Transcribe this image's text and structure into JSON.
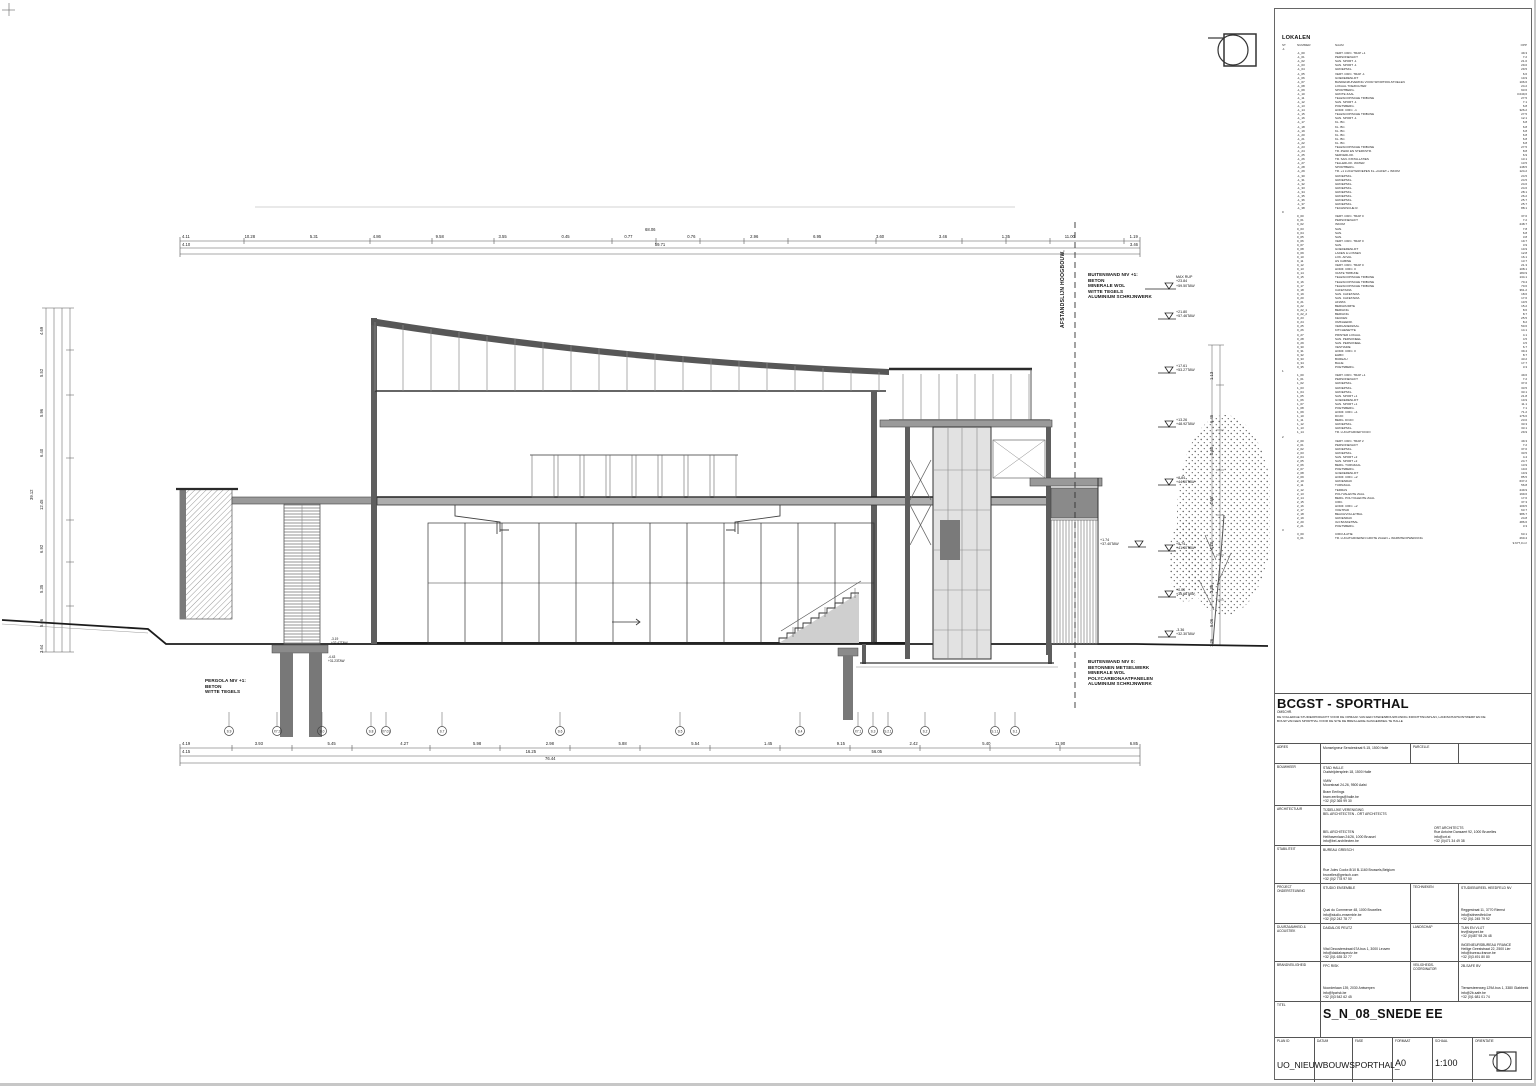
{
  "sheet": {
    "annotations": {
      "buitenwand1": "BUITENWAND NIV +1:\nBETON\nMINERALE WOL\nWITTE TEGELS\nALUMINIUM SCHRIJNWERK",
      "buitenwand0": "BUITENWAND NIV 0:\nBETONNEN METSELWERK\nMINERALE WOL\nPOLYCARBONAATPANELEN\nALUMINIUM SCHRIJNWERK",
      "pergola": "PERGOLA NIV +1:\nBETON\nWITTE TEGELS",
      "afstandslijn": "AFSTANDSLIJN HOOGBOUW,"
    },
    "levels": [
      {
        "top": "MAX RUP",
        "a": "+23.84",
        "b": "+59.50TAW"
      },
      {
        "top": "",
        "a": "+21.80",
        "b": "+57.46TAW"
      },
      {
        "top": "",
        "a": "+17.61",
        "b": "+53.27TAW"
      },
      {
        "top": "",
        "a": "+13.26",
        "b": "+48.92TAW"
      },
      {
        "top": "",
        "a": "+8.84",
        "b": "+44.50TAW"
      },
      {
        "top": "",
        "a": "+5.74",
        "b": "+41.40TAW"
      },
      {
        "top": "",
        "a": "+0.00",
        "b": "+35.66TAW"
      },
      {
        "top": "",
        "a": "-3.36",
        "b": "+32.30TAW"
      }
    ],
    "marks": {
      "mid": "+1.74\n+37.40TAW",
      "foot1": "-3.19\n+32.47TAW",
      "foot2": "-4.43\n+31.23TAW"
    },
    "dims": {
      "top_total": "68.06",
      "top1": [
        "4.11",
        "10.28",
        "5.31",
        "4.86",
        "9.58",
        "3.55",
        "0.45",
        "0.77",
        "0.76",
        "2.96",
        "6.95",
        "3.60",
        "3.46",
        "1.35",
        "11.00",
        "1.19"
      ],
      "top2": [
        "4.10",
        "59.71",
        "3.46"
      ],
      "bot1": [
        "4.19",
        "3.93",
        "5.45",
        "4.27",
        "5.98",
        "2.98",
        "5.88",
        "5.54",
        "1.45",
        "9.15",
        "2.42",
        "5.40",
        "11.90",
        "6.85"
      ],
      "bot2": [
        "4.15",
        "16.25",
        "56.05"
      ],
      "bot_total": "76.44",
      "left": [
        "4.69",
        "5.52",
        "5.96",
        "6.40",
        "12.45",
        "6.92",
        "5.35",
        "5.06",
        "3.64"
      ],
      "left_total": "39.12",
      "right": [
        "1.13",
        "6.45",
        "0.60",
        "4.65",
        "4.10",
        "3.35",
        "5.06",
        "1.26"
      ]
    },
    "grid": {
      "bubbles": [
        "S.9",
        "X7.2",
        "S.0",
        "S.8",
        "X7.01",
        "S.7",
        "S.6",
        "S.5",
        "S.4",
        "X7.1",
        "S.3",
        "S.2.1",
        "S.2",
        "S.1.1",
        "S.1"
      ]
    }
  },
  "lokalen": {
    "title": "LOKALEN",
    "headers": {
      "st": "ST",
      "nr": "NUMMER",
      "naam": "NAAM",
      "opp": "OPP"
    },
    "rows": [
      {
        "st": "-1",
        "nr": "",
        "naam": "",
        "opp": ""
      },
      {
        "st": "",
        "nr": "-1_00",
        "naam": "VERT. CIRC. TRAP +1",
        "opp": "49.3"
      },
      {
        "st": "",
        "nr": "-1_01",
        "naam": "PERSONENLIFT",
        "opp": "7.2"
      },
      {
        "st": "",
        "nr": "-1_02",
        "naam": "SAN. SPORT -1",
        "opp": "21.0"
      },
      {
        "st": "",
        "nr": "-1_03",
        "naam": "SAN. SPORT -1",
        "opp": "29.0"
      },
      {
        "st": "",
        "nr": "-1_04",
        "naam": "GROEPSKL.",
        "opp": "29.5"
      },
      {
        "st": "",
        "nr": "-1_05",
        "naam": "VERT. CIRC. TRAP -1",
        "opp": "6.6"
      },
      {
        "st": "",
        "nr": "-1_06",
        "naam": "GOEDERENLIFT",
        "opp": "10.9"
      },
      {
        "st": "",
        "nr": "-1_07",
        "naam": "BANDENZUIVERING VOOR SPORTROLSTOELEN",
        "opp": "106.6"
      },
      {
        "st": "",
        "nr": "-1_08",
        "naam": "LOKAAL TOEZICHTER",
        "opp": "24.2"
      },
      {
        "st": "",
        "nr": "-1_09",
        "naam": "SPORTBERG.",
        "opp": "93.6"
      },
      {
        "st": "",
        "nr": "-1_10",
        "naam": "GROTE ZAAL",
        "opp": "3.049,6"
      },
      {
        "st": "",
        "nr": "-1_11",
        "naam": "TELESCOPISCHE TRIBUNE",
        "opp": "27.5"
      },
      {
        "st": "",
        "nr": "-1_12",
        "naam": "SAN. SPORT -1",
        "opp": "7.1"
      },
      {
        "st": "",
        "nr": "-1_13",
        "naam": "POETSBERG.",
        "opp": "6.8"
      },
      {
        "st": "",
        "nr": "-1_14",
        "naam": "HORZ. CIRC. -1",
        "opp": "326.2"
      },
      {
        "st": "",
        "nr": "-1_15",
        "naam": "TELESCOPISCHE TRIBUNE",
        "opp": "27.5"
      },
      {
        "st": "",
        "nr": "-1_16",
        "naam": "SAN. SPORT -1",
        "opp": "12.1"
      },
      {
        "st": "",
        "nr": "-1_17",
        "naam": "KL. BC.",
        "opp": "6.8"
      },
      {
        "st": "",
        "nr": "-1_18",
        "naam": "KL. BC.",
        "opp": "6.8"
      },
      {
        "st": "",
        "nr": "-1_19",
        "naam": "KL. BC.",
        "opp": "6.8"
      },
      {
        "st": "",
        "nr": "-1_20",
        "naam": "KL. BC.",
        "opp": "6.8"
      },
      {
        "st": "",
        "nr": "-1_21",
        "naam": "KL. BC.",
        "opp": "6.8"
      },
      {
        "st": "",
        "nr": "-1_22",
        "naam": "KL. BC.",
        "opp": "6.8"
      },
      {
        "st": "",
        "nr": "-1_23",
        "naam": "TELESCOPISCHE TRIBUNE",
        "opp": "27.5"
      },
      {
        "st": "",
        "nr": "-1_24",
        "naam": "TR. ZWAK EN STERKSTR.",
        "opp": "8.8"
      },
      {
        "st": "",
        "nr": "-1_25",
        "naam": "SERVERLOK.",
        "opp": "6.9"
      },
      {
        "st": "",
        "nr": "-1_26",
        "naam": "TR. SAN. INSTALLATIES",
        "opp": "13.1"
      },
      {
        "st": "",
        "nr": "-1_27",
        "naam": "TELLERLOK. WATER",
        "opp": "13.5"
      },
      {
        "st": "",
        "nr": "-1_28",
        "naam": "SPORTBERG.",
        "opp": "148.5"
      },
      {
        "st": "",
        "nr": "-1_29",
        "naam": "TR. +1 LUCHTGROEPEN KL.+CAFET.+ INKOM",
        "opp": "124.2"
      },
      {
        "st": "",
        "nr": "-1_30",
        "naam": "GROEPSKL.",
        "opp": "24.5"
      },
      {
        "st": "",
        "nr": "-1_31",
        "naam": "GROEPSKL.",
        "opp": "24.5"
      },
      {
        "st": "",
        "nr": "-1_32",
        "naam": "GROEPSKL.",
        "opp": "24.6"
      },
      {
        "st": "",
        "nr": "-1_33",
        "naam": "GROEPSKL.",
        "opp": "24.6"
      },
      {
        "st": "",
        "nr": "-1_34",
        "naam": "GROEPSKL.",
        "opp": "28.1"
      },
      {
        "st": "",
        "nr": "-1_35",
        "naam": "GROEPSKL.",
        "opp": "26.2"
      },
      {
        "st": "",
        "nr": "-1_36",
        "naam": "GROEPSKL.",
        "opp": "25.7"
      },
      {
        "st": "",
        "nr": "-1_37",
        "naam": "GROEPSKL.",
        "opp": "25.7"
      },
      {
        "st": "",
        "nr": "-1_38",
        "naam": "TECHNISCHE R.",
        "opp": "88.1"
      },
      {
        "st": "0",
        "nr": "",
        "naam": "",
        "opp": ""
      },
      {
        "st": "",
        "nr": "0_00",
        "naam": "VERT. CIRC. TRAP 0",
        "opp": "37.0"
      },
      {
        "st": "",
        "nr": "0_01",
        "naam": "PERSONENLIFT",
        "opp": "7.2"
      },
      {
        "st": "",
        "nr": "0_02",
        "naam": "INKOM",
        "opp": "248.7"
      },
      {
        "st": "",
        "nr": "0_03",
        "naam": "SAN.",
        "opp": "7.8"
      },
      {
        "st": "",
        "nr": "0_04",
        "naam": "SAN.",
        "opp": "6.8"
      },
      {
        "st": "",
        "nr": "0_05",
        "naam": "SAN.",
        "opp": "3.8"
      },
      {
        "st": "",
        "nr": "0_06",
        "naam": "VERT. CIRC. TRAP 0",
        "opp": "19.7"
      },
      {
        "st": "",
        "nr": "0_07",
        "naam": "SAN.",
        "opp": "3.9"
      },
      {
        "st": "",
        "nr": "0_08",
        "naam": "GOEDERENLIFT",
        "opp": "10.9"
      },
      {
        "st": "",
        "nr": "0_09",
        "naam": "LADEN & LOSSEN",
        "opp": "12.8"
      },
      {
        "st": "",
        "nr": "0_10",
        "naam": "LOK. AFVAL",
        "opp": "16.1"
      },
      {
        "st": "",
        "nr": "0_11",
        "naam": "HS CABINE",
        "opp": "13.7"
      },
      {
        "st": "",
        "nr": "0_12",
        "naam": "VERT. CIRC. TRAP 0",
        "opp": "21.3"
      },
      {
        "st": "",
        "nr": "0_13",
        "naam": "HORZ. CIRC. 0",
        "opp": "108.1"
      },
      {
        "st": "",
        "nr": "0_14",
        "naam": "VASTE TRIBUNE",
        "opp": "183.9"
      },
      {
        "st": "",
        "nr": "0_15",
        "naam": "TELESCOPISCHE TRIBUNE",
        "opp": "134.1"
      },
      {
        "st": "",
        "nr": "0_16",
        "naam": "TELESCOPISCHE TRIBUNE",
        "opp": "70.4"
      },
      {
        "st": "",
        "nr": "0_17",
        "naam": "TELESCOPISCHE TRIBUNE",
        "opp": "70.6"
      },
      {
        "st": "",
        "nr": "0_18",
        "naam": "CAFETARIA",
        "opp": "361.2"
      },
      {
        "st": "",
        "nr": "0_19",
        "naam": "SAN. CAFETARIA",
        "opp": "18.6"
      },
      {
        "st": "",
        "nr": "0_20",
        "naam": "SAN. CAFETARIA",
        "opp": "17.6"
      },
      {
        "st": "",
        "nr": "0_21",
        "naam": "AFWAS",
        "opp": "10.5"
      },
      {
        "st": "",
        "nr": "0_22",
        "naam": "BERGRUIMTE",
        "opp": "15.2"
      },
      {
        "st": "",
        "nr": "0_22_1",
        "naam": "BERGING",
        "opp": "8.6"
      },
      {
        "st": "",
        "nr": "0_22_2",
        "naam": "BERGING",
        "opp": "8.7"
      },
      {
        "st": "",
        "nr": "0_23",
        "naam": "KEUKEN",
        "opp": "25.5"
      },
      {
        "st": "",
        "nr": "0_24",
        "naam": "OMKLEEDR.",
        "opp": "8.2"
      },
      {
        "st": "",
        "nr": "0_25",
        "naam": "VERGADERZAAL",
        "opp": "50.6"
      },
      {
        "st": "",
        "nr": "0_26",
        "naam": "KITCHENETTE",
        "opp": "14.1"
      },
      {
        "st": "",
        "nr": "0_27",
        "naam": "PRINTER LOKAAL",
        "opp": "4.1"
      },
      {
        "st": "",
        "nr": "0_28",
        "naam": "SAN. PERSONEEL",
        "opp": "4.5"
      },
      {
        "st": "",
        "nr": "0_29",
        "naam": "SAN. PERSONEEL",
        "opp": "4.5"
      },
      {
        "st": "",
        "nr": "0_30",
        "naam": "VESTIAIRE",
        "opp": "6.7"
      },
      {
        "st": "",
        "nr": "0_31",
        "naam": "HORZ. CIRC. 0",
        "opp": "39.4"
      },
      {
        "st": "",
        "nr": "0_32",
        "naam": "EHBO",
        "opp": "8.7"
      },
      {
        "st": "",
        "nr": "0_33",
        "naam": "BUREAU",
        "opp": "43.2"
      },
      {
        "st": "",
        "nr": "0_34",
        "naam": "BALIE",
        "opp": "17.7"
      },
      {
        "st": "",
        "nr": "0_35",
        "naam": "POETSBERG.",
        "opp": "3.3"
      },
      {
        "st": "1",
        "nr": "",
        "naam": "",
        "opp": ""
      },
      {
        "st": "",
        "nr": "1_00",
        "naam": "VERT. CIRC. TRAP +1",
        "opp": "49.6"
      },
      {
        "st": "",
        "nr": "1_01",
        "naam": "PERSONENLIFT",
        "opp": "7.2"
      },
      {
        "st": "",
        "nr": "1_02",
        "naam": "GROEPSKL.",
        "opp": "37.0"
      },
      {
        "st": "",
        "nr": "1_03",
        "naam": "GROEPSKL.",
        "opp": "33.5"
      },
      {
        "st": "",
        "nr": "1_04",
        "naam": "GROEPSKL.",
        "opp": "33.1"
      },
      {
        "st": "",
        "nr": "1_05",
        "naam": "SAN. SPORT +1",
        "opp": "21.8"
      },
      {
        "st": "",
        "nr": "1_06",
        "naam": "GOEDERENLIFT",
        "opp": "10.9"
      },
      {
        "st": "",
        "nr": "1_07",
        "naam": "SAN. SPORT +1",
        "opp": "11.1"
      },
      {
        "st": "",
        "nr": "1_08",
        "naam": "POETSBERG.",
        "opp": "7.1"
      },
      {
        "st": "",
        "nr": "1_09",
        "naam": "HORZ. CIRC. +1",
        "opp": "71.2"
      },
      {
        "st": "",
        "nr": "1_10",
        "naam": "DOJO",
        "opp": "176.6"
      },
      {
        "st": "",
        "nr": "1_11",
        "naam": "BERG. DOJO",
        "opp": "23.0"
      },
      {
        "st": "",
        "nr": "1_12",
        "naam": "GROEPSKL.",
        "opp": "33.3"
      },
      {
        "st": "",
        "nr": "1_13",
        "naam": "GROEPSKL.",
        "opp": "33.1"
      },
      {
        "st": "",
        "nr": "1_14",
        "naam": "TR. LUCHTGROEP DOJO",
        "opp": "29.9"
      },
      {
        "st": "2",
        "nr": "",
        "naam": "",
        "opp": ""
      },
      {
        "st": "",
        "nr": "2_00",
        "naam": "VERT. CIRC. TRAP 2",
        "opp": "49.3"
      },
      {
        "st": "",
        "nr": "2_01",
        "naam": "PERSONENLIFT",
        "opp": "7.2"
      },
      {
        "st": "",
        "nr": "2_02",
        "naam": "GROEPSKL.",
        "opp": "37.0"
      },
      {
        "st": "",
        "nr": "2_03",
        "naam": "GROEPSKL.",
        "opp": "33.5"
      },
      {
        "st": "",
        "nr": "2_04",
        "naam": "SAN. SPORT +2",
        "opp": "4.4"
      },
      {
        "st": "",
        "nr": "2_05",
        "naam": "SAN. SPORT +2",
        "opp": "24.7"
      },
      {
        "st": "",
        "nr": "2_06",
        "naam": "BERG. TURNZAAL",
        "opp": "13.9"
      },
      {
        "st": "",
        "nr": "2_07",
        "naam": "POETSBERG.",
        "opp": "10.0"
      },
      {
        "st": "",
        "nr": "2_08",
        "naam": "GOEDERENLIFT",
        "opp": "10.9"
      },
      {
        "st": "",
        "nr": "2_09",
        "naam": "HORZ. CIRC. +2",
        "opp": "85.5"
      },
      {
        "st": "",
        "nr": "2_10",
        "naam": "GROENDAK",
        "opp": "637.2"
      },
      {
        "st": "",
        "nr": "2_11",
        "naam": "TURNZAAL",
        "opp": "56.8"
      },
      {
        "st": "",
        "nr": "2_12",
        "naam": "TERRAS",
        "opp": "249.9"
      },
      {
        "st": "",
        "nr": "2_13",
        "naam": "POLYVALENTE ZAAL",
        "opp": "199.6"
      },
      {
        "st": "",
        "nr": "2_14",
        "naam": "BERG. POLYVALENTE ZAAL",
        "opp": "17.6"
      },
      {
        "st": "",
        "nr": "2_15",
        "naam": "CIRC.",
        "opp": "37.3"
      },
      {
        "st": "",
        "nr": "2_16",
        "naam": "HORZ. CIRC. +2",
        "opp": "109.5"
      },
      {
        "st": "",
        "nr": "2_17",
        "naam": "VOETPAD",
        "opp": "63.7"
      },
      {
        "st": "",
        "nr": "2_18",
        "naam": "BEACHVOLLEYBAL",
        "opp": "386.7"
      },
      {
        "st": "",
        "nr": "2_19",
        "naam": "GROENDAK",
        "opp": "24.8"
      },
      {
        "st": "",
        "nr": "2_20",
        "naam": "3x3 BASKETBAL",
        "opp": "486.6"
      },
      {
        "st": "",
        "nr": "2_21",
        "naam": "POETSBERG.",
        "opp": "3.3"
      },
      {
        "st": "3",
        "nr": "",
        "naam": "",
        "opp": ""
      },
      {
        "st": "",
        "nr": "3_00",
        "naam": "CIRCULATIE",
        "opp": "63.1"
      },
      {
        "st": "",
        "nr": "3_01",
        "naam": "TR. LUCHTGROEPEN GROTE ZALEN + WARMTEOPWEKKING",
        "opp": "260.4"
      },
      {
        "st": "",
        "nr": "",
        "naam": "",
        "opp": "9.677,0 m²"
      }
    ]
  },
  "titleblock": {
    "project_title": "BCGST - SPORTHAL",
    "desc_label": "OMSCHR.",
    "description": "DE VOLLEDIGE STUDIEOPDRACHT VOOR DE OPMAAK VAN EEN STEDENBOUWKUNDIG INRICHTINGSPLAN, LANDSCHAPSONTWERP EN DE\nBOUW VAN EEN SPORTHAL VOOR DE SITE DE BRES-LEIDE-SLINGERWEG TE HALLE",
    "adres_label": "ADRES",
    "adres": "Monseigneur Senciestraat 9-15, 1500 Halle",
    "parcelle_label": "PARCELLE",
    "parcelle": "",
    "bouwheer_label": "BOUWHEER",
    "bouwheer_top": "STAD HALLE\nOudstrijdersplein 18, 1500 Halle\n\nVMW\nMoorstraat 24-26, 9500 Aalst",
    "bouwheer_bottom": "Bram Eerlings\nbram.eerlings@halle.be\n+32 (0)2 365 99 30",
    "architect_label": "ARCHITECTUUR",
    "architect_tv": "TIJDELIJKE VERENIGING\nBEL ARCHITECTEN - ORT ARCHITECTS",
    "architect_left": "BEL ARCHITECTEN\nHelihavenlaan 24/26, 1000 Brussel\ninfo@bel-architecten.be",
    "architect_right": "ORT ARCHITECTS\nRue Antoine Dansaert 92, 1000 Bruxelles\ninfo@ort.st\n+32 (0)471 34 49 38",
    "stabiliteit_label": "STABILITEIT",
    "stabiliteit_name": "BUREAU GREISCH",
    "stabiliteit_addr": "Rue Jules Cockx 8/10 B-1160 Brussels,Belgium\nbruxelles@greisch.com\n+32 (0)2 778 97 50",
    "project_label": "PROJECT\nONDERSTEUNING",
    "project_name": "STUDIO ENSEMBLE",
    "project_addr": "Quai du Commerce 48, 1000 Bruxelles\ninfo@studio-ensemble.be\n+32 (0)2 242 78 77",
    "technieken_label": "TECHNIEKEN",
    "technieken_name": "STUDIEBUREEL HEEDFELD NV",
    "technieken_addr": "Reggestraat 11, 3770 Riemst\ninfo@sbheedfeld.be\n+32 (0)1 245 79 92",
    "duurzaam_label": "DUURZAAMHEID &\nACOUSTIEK",
    "duurzaam_name": "DAIDALOS PEUTZ",
    "duurzaam_addr": "Vital Decosterstraat 67A bus 1, 3000 Leuven\ninfo@daidalospeutz.be\n+32 (0)1 635 32 77",
    "landschap_label": "LANDSCHAP",
    "landschap_content": "TUIN EN VLIJT\ntev@skynet.be\n+32 (0)487 98 26 48\n\nINGENIEURSBUREAU FRANCE\nHeilige Geeststraat 22, 2500 Lier\ninfo@bureau-france.be\n+32 (0)3 491 80 80",
    "brand_label": "BRANDVEILIGHEID",
    "brand_name": "FPC RISK",
    "brand_addr": "Noorderlaan 139, 2030 Antwerpen\ninfo@fpcrisk.be\n+32 (0)3 542 62 45",
    "veilig_label": "VEILIGHEIDS-\nCOÖRDINATOR",
    "veilig_name": "2B-SAFE BV",
    "veilig_addr": "Tiensesteenweg 129A bus 1, 3380 Glabbeek\ninfo@2b-safe.be\n+32 (0)1 681 01 74",
    "titel_label": "TITEL",
    "titel": "S_N_08_SNEDE EE",
    "planid_label": "PLAN ID",
    "planid": "UO_NIEUWBOUWSPORTHAL_",
    "datum_label": "DATUM",
    "datum": "",
    "fase_label": "FASE",
    "fase": "",
    "formaat_label": "FORMAAT",
    "formaat": "A0",
    "schaal_label": "SCHAAL",
    "schaal": "1:100",
    "orientatie_label": "ORIENTATIE"
  }
}
